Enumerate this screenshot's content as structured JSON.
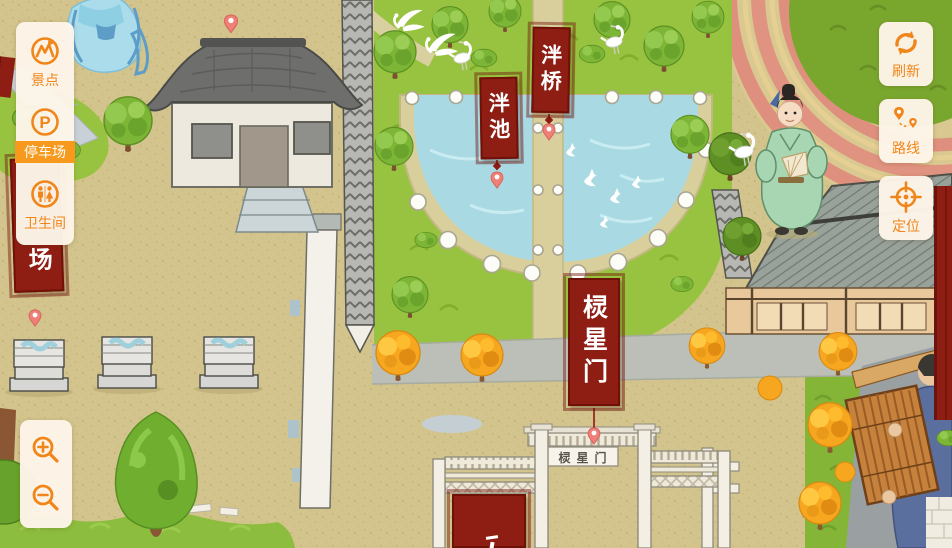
{
  "ui": {
    "accent_color": "#f08519",
    "highlight_color": "#f7991c",
    "panel_bg": "#fdf5e9",
    "left_panel": {
      "items": [
        {
          "label": "景点",
          "icon": "scenic-spots-icon",
          "selected": false
        },
        {
          "label": "停车场",
          "icon": "parking-icon",
          "glyph": "P",
          "selected": true
        },
        {
          "label": "卫生间",
          "icon": "restroom-icon",
          "selected": false
        }
      ]
    },
    "right_buttons": [
      {
        "label": "刷新",
        "icon": "refresh-icon"
      },
      {
        "label": "路线",
        "icon": "route-icon"
      },
      {
        "label": "定位",
        "icon": "locate-icon"
      }
    ],
    "zoom_controls": {
      "icons": [
        "zoom-in-icon",
        "zoom-out-icon"
      ]
    }
  },
  "map": {
    "banner_color": "#8e1d13",
    "labels": {
      "pond_banner": "泮池",
      "bridge_banner": "泮桥",
      "gate_banner": "棂星门",
      "gate_plaque": "棂星门",
      "parking_banner_visible": "场"
    }
  }
}
